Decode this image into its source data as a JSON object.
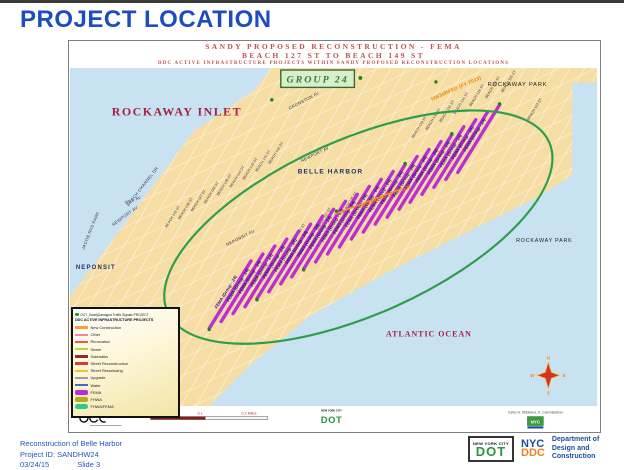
{
  "slide": {
    "title": "PROJECT LOCATION",
    "footer": {
      "project_name": "Reconstruction of Belle Harbor",
      "project_id": "Project ID: SANDHW24",
      "date": "03/24/15",
      "slide_number": "Slide 3",
      "dot_logo": {
        "top": "NEW YORK CITY",
        "main": "DOT"
      },
      "ddc_logo": {
        "top": "NYC",
        "main": "DDC"
      },
      "department": {
        "line1": "Department of",
        "line2": "Design and",
        "line3": "Construction"
      }
    }
  },
  "map": {
    "header": {
      "line1": "SANDY PROPOSED RECONSTRUCTION - FEMA",
      "line2": "BEACH 127 ST TO BEACH 149 ST",
      "line3": "DDC ACTIVE INFRASTRUCTURE PROJECTS WITHIN SANDY PROPOSED RECONSTRUCTION LOCATIONS"
    },
    "group_label": "GROUP 24",
    "fema_label": "FEMA (Group - 24)",
    "hw_label": "HW34RFED (FY 2013)",
    "areas": {
      "inlet": "ROCKAWAY INLET",
      "rockaway_park": "ROCKAWAY PARK",
      "belle_harbor": "BELLE HARBOR",
      "neponsit": "NEPONSIT",
      "ocean": "ATLANTIC OCEAN"
    },
    "streets": [
      "BEACH 149 ST",
      "BEACH 148 ST",
      "BEACH 147 ST",
      "BEACH 146 ST",
      "BEACH 145 ST",
      "BEACH 144 ST",
      "BEACH 143 ST",
      "BEACH 142 ST",
      "BEACH 141 ST",
      "BEACH 139 ST",
      "BEACH 137 ST",
      "BEACH 135 ST",
      "BEACH 133 ST",
      "BEACH 132 ST",
      "BEACH 131 ST",
      "BEACH 130 ST",
      "BEACH 128 ST",
      "BEACH 126 ST",
      "BEACH 125 ST",
      "BEACH 123 ST"
    ],
    "avenues": [
      "CRONSTON AV",
      "NEWPORT AV",
      "NEWPORT AV",
      "RIIS AV",
      "BEACH CHANNEL DR",
      "NEPONSIT AV",
      "JACOB RIIS PARK"
    ],
    "compass": {
      "n": "N",
      "e": "E",
      "s": "S",
      "w": "W"
    },
    "scale_ticks": [
      "0",
      "0.05",
      "0.1",
      "0.2 Miles"
    ],
    "mini_dot_logo": {
      "top": "NEW YORK CITY",
      "main": "DOT"
    },
    "mini_nyc_logo": "NYC",
    "commissioner": "Carter H. Strickland, Jr., Commissioner",
    "colors": {
      "fema_line": "#bb2fd0",
      "ellipse": "#2f9e4a",
      "hw_orange": "#e8820c",
      "land": "#f6dda3",
      "water": "#c8e2f2"
    }
  },
  "legend": {
    "signals_label": "DOT_SandyDamaged Traffic Signals PROJECT",
    "header": "DDC ACTIVE INFRASTRUCTURE PROJECTS",
    "items": [
      {
        "label": "New Construction",
        "color": "#f2a13c"
      },
      {
        "label": "Other",
        "color": "#f2879c"
      },
      {
        "label": "Renovation",
        "color": "#e85a3a"
      },
      {
        "label": "Sewer",
        "color": "#c9cf3a"
      },
      {
        "label": "Sidewalks",
        "color": "#8c2f2b"
      },
      {
        "label": "Street Reconstruction",
        "color": "#e03a2f"
      },
      {
        "label": "Street Resurfacing",
        "color": "#f4c032"
      },
      {
        "label": "Upgrade",
        "color": "#9aa0a6"
      },
      {
        "label": "Water",
        "color": "#3b6cc7"
      },
      {
        "label": "FEMA",
        "color": "#c428d4"
      },
      {
        "label": "FHWA",
        "color": "#b8a81f"
      },
      {
        "label": "FHWA/FEMA",
        "color": "#2fc98e"
      }
    ]
  }
}
